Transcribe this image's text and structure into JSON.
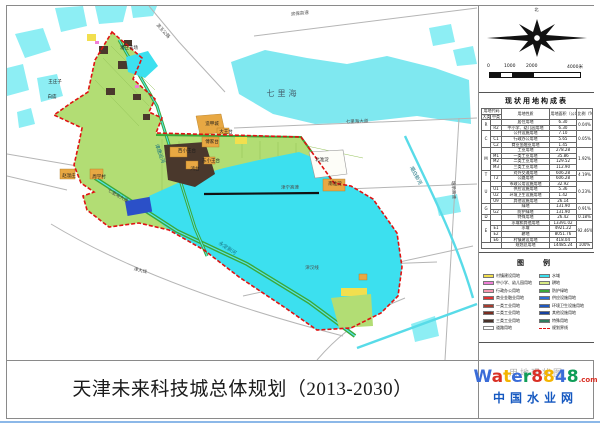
{
  "title_block": {
    "project_title": "天津未来科技城总体规划（2013-2030）",
    "sheet_label": "用地现状图"
  },
  "watermark": {
    "brand_letters": [
      {
        "ch": "W",
        "color": "#3a6cd8"
      },
      {
        "ch": "a",
        "color": "#d93025"
      },
      {
        "ch": "t",
        "color": "#f4b400"
      },
      {
        "ch": "e",
        "color": "#3a6cd8"
      },
      {
        "ch": "r",
        "color": "#0f9d58"
      },
      {
        "ch": "8",
        "color": "#d93025"
      },
      {
        "ch": "8",
        "color": "#f4b400"
      },
      {
        "ch": "4",
        "color": "#3a6cd8"
      },
      {
        "ch": "8",
        "color": "#0f9d58"
      }
    ],
    "suffix": ".com",
    "site_name": "中国水业网"
  },
  "sidebar": {
    "north_label": "北",
    "scale": {
      "labels": [
        {
          "t": "0",
          "x": 0
        },
        {
          "t": "1000",
          "x": 17
        },
        {
          "t": "2000",
          "x": 39
        },
        {
          "t": "4000米",
          "x": 80
        }
      ],
      "segments": [
        {
          "w": 11,
          "c": "#111"
        },
        {
          "w": 11,
          "c": "#fff"
        },
        {
          "w": 22,
          "c": "#111"
        },
        {
          "w": 44,
          "c": "#fff"
        }
      ]
    },
    "table": {
      "title": "现状用地构成表",
      "header": {
        "code_group": "用地代码",
        "code_major": "大类",
        "code_minor": "中类",
        "name": "用地性质",
        "area": "用地面积（公顷）",
        "pct": "比例（%）"
      },
      "rows": [
        {
          "major": "R",
          "span": 2,
          "name": "居住用地",
          "area": "6.30",
          "pct": "0.04%"
        },
        {
          "minor": "R2",
          "name": "中小学、幼儿园用地",
          "area": "6.30"
        },
        {
          "major": "C",
          "span": 3,
          "name": "公共设施用地",
          "area": "7.10",
          "pct": "0.05%"
        },
        {
          "minor": "C1",
          "name": "行政办公用地",
          "area": "5.65"
        },
        {
          "minor": "C2",
          "name": "商业金融业用地",
          "area": "1.45"
        },
        {
          "major": "M",
          "span": 4,
          "name": "工业用地",
          "area": "278.28",
          "pct": "1.92%"
        },
        {
          "minor": "M1",
          "name": "一类工业用地",
          "area": "35.86"
        },
        {
          "minor": "M2",
          "name": "二类工业用地",
          "area": "129.52"
        },
        {
          "minor": "M3",
          "name": "三类工业用地",
          "area": "112.90"
        },
        {
          "major": "T",
          "span": 2,
          "name": "对外交通用地",
          "area": "606.28",
          "pct": "4.19%"
        },
        {
          "minor": "T2",
          "name": "公路用地",
          "area": "606.28"
        },
        {
          "major": "U",
          "span": 4,
          "name": "市政公用设施用地",
          "area": "32.92",
          "pct": "0.23%"
        },
        {
          "minor": "U1",
          "name": "供应设施用地",
          "area": "5.36"
        },
        {
          "minor": "U2",
          "name": "环境卫生设施用地",
          "area": "1.42"
        },
        {
          "minor": "U9",
          "name": "其他设施用地",
          "area": "26.14"
        },
        {
          "major": "G",
          "span": 2,
          "name": "绿地",
          "area": "131.90",
          "pct": "0.91%"
        },
        {
          "minor": "G2",
          "name": "防护绿地",
          "area": "131.90"
        },
        {
          "major": "D",
          "span": 1,
          "name": "特殊用地",
          "area": "26.42",
          "pct": "0.18%"
        },
        {
          "major": "E",
          "span": 4,
          "name": "水域和其他用地",
          "area": "13391.02",
          "pct": "92.46%"
        },
        {
          "minor": "E1",
          "name": "水域",
          "area": "4921.22"
        },
        {
          "minor": "E2",
          "name": "耕地",
          "area": "8051.76"
        },
        {
          "minor": "E6",
          "name": "村镇建设用地",
          "area": "418.04"
        },
        {
          "total": true,
          "span": 1,
          "name": "规划总用地",
          "area": "14485.24",
          "pct": "100%"
        }
      ]
    },
    "legend": {
      "title": "图　例",
      "left": [
        {
          "label": "村镇建设用地",
          "color": "#f2df4e",
          "type": "fill"
        },
        {
          "label": "中小学、幼儿园用地",
          "color": "#f080d8",
          "type": "fill"
        },
        {
          "label": "行政办公用地",
          "color": "#f598b0",
          "type": "fill"
        },
        {
          "label": "商业金融业用地",
          "color": "#e03030",
          "type": "fill"
        },
        {
          "label": "一类工业用地",
          "color": "#a63c2e",
          "type": "fill"
        },
        {
          "label": "二类工业用地",
          "color": "#7a2c20",
          "type": "fill"
        },
        {
          "label": "三类工业用地",
          "color": "#4a3228",
          "type": "fill"
        },
        {
          "label": "道路用地",
          "color": "#ffffff",
          "type": "road"
        }
      ],
      "right": [
        {
          "label": "水域",
          "color": "#3ce0ef",
          "type": "fill"
        },
        {
          "label": "耕地",
          "color": "#d8ea84",
          "type": "fill"
        },
        {
          "label": "防护绿地",
          "color": "#3aa83a",
          "type": "fill"
        },
        {
          "label": "供应设施用地",
          "color": "#2e6fd6",
          "type": "fill"
        },
        {
          "label": "环境卫生设施用地",
          "color": "#1f58c0",
          "type": "fill"
        },
        {
          "label": "其他设施用地",
          "color": "#16409e",
          "type": "fill"
        },
        {
          "label": "特殊用地",
          "color": "#2f7d60",
          "type": "fill"
        },
        {
          "label": "规划界线",
          "color": "#e01212",
          "type": "dash"
        }
      ]
    }
  },
  "map": {
    "labels": [
      {
        "text": "七里海",
        "x": 276,
        "y": 88,
        "rot": 0,
        "cls": "water-lg"
      },
      {
        "text": "潮白新河",
        "x": 408,
        "y": 170,
        "rot": 62,
        "cls": "water-sm"
      },
      {
        "text": "津唐运河",
        "x": 152,
        "y": 148,
        "rot": 70,
        "cls": "water-sm"
      },
      {
        "text": "永定新河",
        "x": 220,
        "y": 243,
        "rot": 33,
        "cls": "water-sm"
      },
      {
        "text": "滨保高速",
        "x": 293,
        "y": 9,
        "rot": -6,
        "cls": "road-sm"
      },
      {
        "text": "滨玉公路",
        "x": 155,
        "y": 26,
        "rot": 48,
        "cls": "road-sm"
      },
      {
        "text": "七里海大道",
        "x": 350,
        "y": 117,
        "rot": -2,
        "cls": "road-sm"
      },
      {
        "text": "七里海大道",
        "x": 110,
        "y": 191,
        "rot": 30,
        "cls": "road-sm"
      },
      {
        "text": "津宁高速",
        "x": 283,
        "y": 183,
        "rot": -1,
        "cls": "road-sm"
      },
      {
        "text": "津汉线",
        "x": 305,
        "y": 263,
        "rot": 0,
        "cls": "road-sm"
      },
      {
        "text": "津大线",
        "x": 133,
        "y": 266,
        "rot": 14,
        "cls": "road-sm"
      },
      {
        "text": "塘承高速",
        "x": 445,
        "y": 184,
        "rot": 87,
        "cls": "road-sm"
      },
      {
        "text": "潘庄农场",
        "x": 122,
        "y": 43,
        "rot": 0,
        "cls": "place"
      },
      {
        "text": "王庄子",
        "x": 48,
        "y": 77,
        "rot": 0,
        "cls": "place"
      },
      {
        "text": "白庙",
        "x": 45,
        "y": 92,
        "rot": 0,
        "cls": "place"
      },
      {
        "text": "造甲城",
        "x": 205,
        "y": 119,
        "rot": 0,
        "cls": "place"
      },
      {
        "text": "大王台",
        "x": 219,
        "y": 127,
        "rot": 0,
        "cls": "place"
      },
      {
        "text": "傅家台",
        "x": 205,
        "y": 137,
        "rot": 0,
        "cls": "place"
      },
      {
        "text": "西小王台",
        "x": 180,
        "y": 146,
        "rot": 0,
        "cls": "place"
      },
      {
        "text": "东小王台",
        "x": 204,
        "y": 156,
        "rot": 0,
        "cls": "place"
      },
      {
        "text": "鸿台",
        "x": 188,
        "y": 164,
        "rot": 0,
        "cls": "place"
      },
      {
        "text": "赵温庄",
        "x": 62,
        "y": 171,
        "rot": 0,
        "cls": "place"
      },
      {
        "text": "周学村",
        "x": 92,
        "y": 172,
        "rot": 0,
        "cls": "place"
      },
      {
        "text": "北淮淀",
        "x": 315,
        "y": 155,
        "rot": 0,
        "cls": "place"
      },
      {
        "text": "南淮淀",
        "x": 328,
        "y": 179,
        "rot": 0,
        "cls": "place"
      }
    ]
  }
}
